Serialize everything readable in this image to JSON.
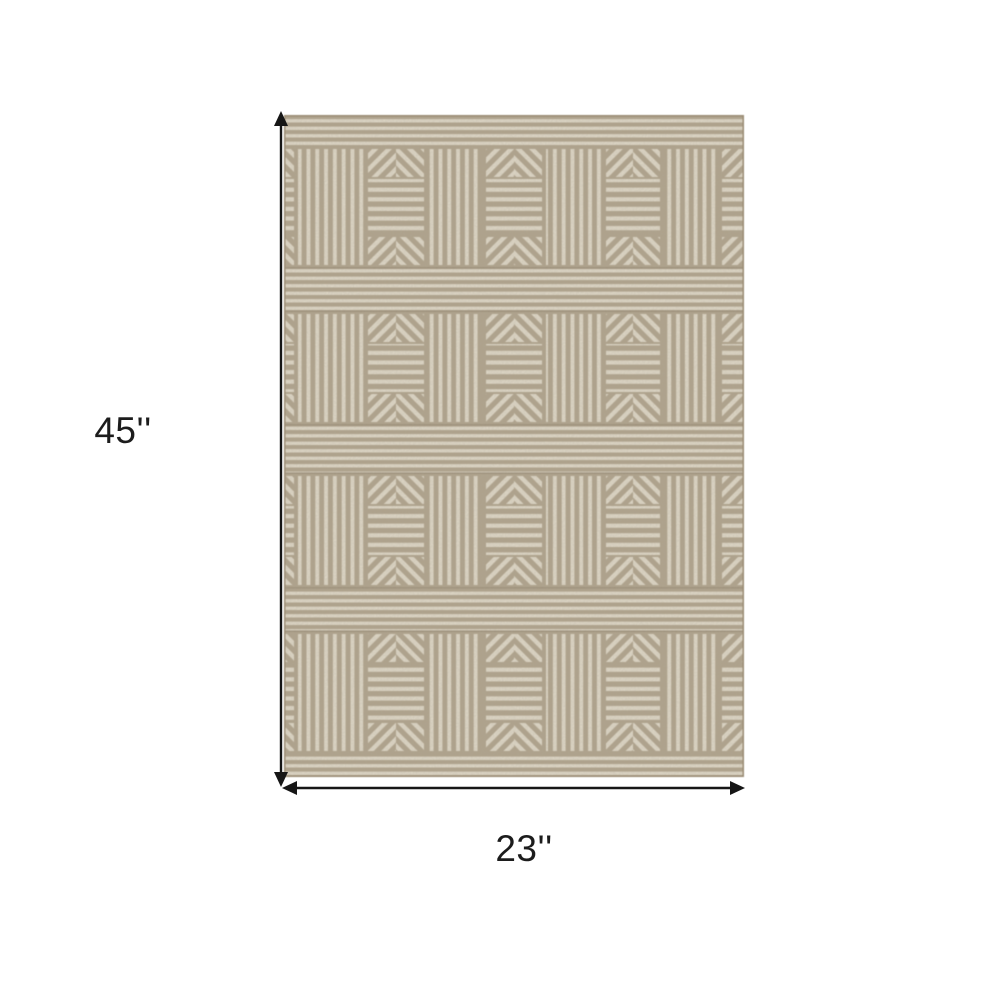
{
  "scene": {
    "background": "#ffffff",
    "description": "Dimension diagram of a beige and ivory geometric striped area rug"
  },
  "dimensions": {
    "height": {
      "label": "45''"
    },
    "width": {
      "label": "23''"
    },
    "line_color": "#161616",
    "text_color": "#1c1c1c"
  },
  "rug": {
    "colors": {
      "tan": "#afa188",
      "tan_dark": "#9a8c74",
      "cream": "#eae3d2"
    },
    "pattern": {
      "rows": 4,
      "top_band_height": 32,
      "bottom_band_height": 24,
      "inner_band_heights": [
        45,
        50,
        45
      ],
      "row_heights": [
        120,
        112,
        113,
        121
      ],
      "chevron_section_height": 28,
      "cells": [
        {
          "type": "chevron-partial-right",
          "width": 12
        },
        {
          "type": "vstripe",
          "width": 70
        },
        {
          "type": "chevron",
          "width": 60
        },
        {
          "type": "vstripe",
          "width": 58
        },
        {
          "type": "chevron",
          "width": 60
        },
        {
          "type": "vstripe",
          "width": 60
        },
        {
          "type": "chevron",
          "width": 58
        },
        {
          "type": "vstripe",
          "width": 58
        },
        {
          "type": "chevron-partial-left",
          "width": 24
        }
      ]
    }
  }
}
